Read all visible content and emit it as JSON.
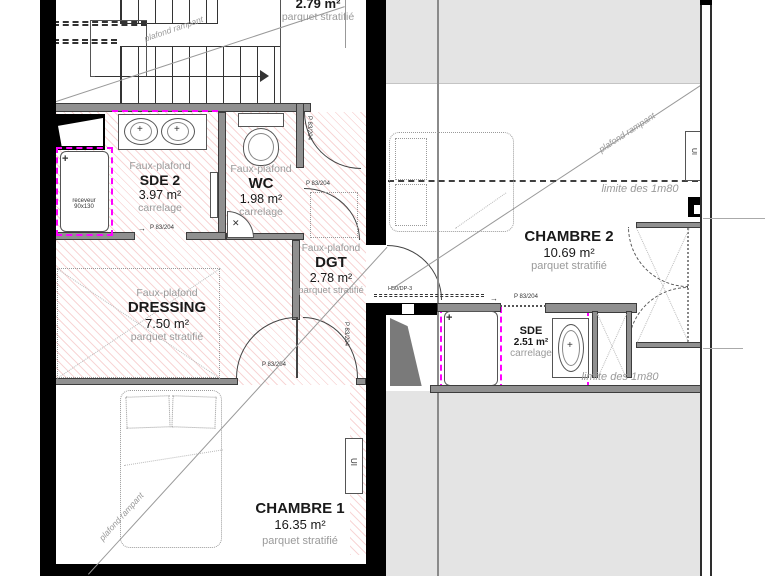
{
  "colors": {
    "hatch_pink": "#e87979",
    "magenta": "#ff00ff",
    "wall_gray": "#909090",
    "zone_gray": "#e4e4e4"
  },
  "rooms": {
    "palier": {
      "area": "2.79 m²",
      "floor": "parquet stratifié"
    },
    "sde2": {
      "ceiling": "Faux-plafond",
      "name": "SDE 2",
      "area": "3.97 m²",
      "floor": "carrelage"
    },
    "wc": {
      "ceiling": "Faux-plafond",
      "name": "WC",
      "area": "1.98 m²",
      "floor": "carrelage"
    },
    "dgt": {
      "ceiling": "Faux-plafond",
      "name": "DGT",
      "area": "2.78 m²",
      "floor": "parquet stratifié"
    },
    "dressing": {
      "ceiling": "Faux-plafond",
      "name": "DRESSING",
      "area": "7.50 m²",
      "floor": "parquet stratifié"
    },
    "chambre1": {
      "name": "CHAMBRE 1",
      "area": "16.35 m²",
      "floor": "parquet stratifié"
    },
    "chambre2": {
      "name": "CHAMBRE 2",
      "area": "10.69 m²",
      "floor": "parquet stratifié"
    },
    "sde": {
      "name": "SDE",
      "area": "2.51 m²",
      "floor": "carrelage"
    }
  },
  "annotations": {
    "plafond_rampant": "plafond rampant",
    "limite_1m80": "limite des 1m80",
    "door_label": "P 83/204",
    "window_label": "H50/DP-3",
    "receveur_line1": "receveur",
    "receveur_line2": "90x130",
    "radiator_label": "UI"
  },
  "icons": {
    "drain_cross": "+",
    "basin_cross": "✕",
    "tap_cross": "+",
    "arrow_right": "→"
  }
}
